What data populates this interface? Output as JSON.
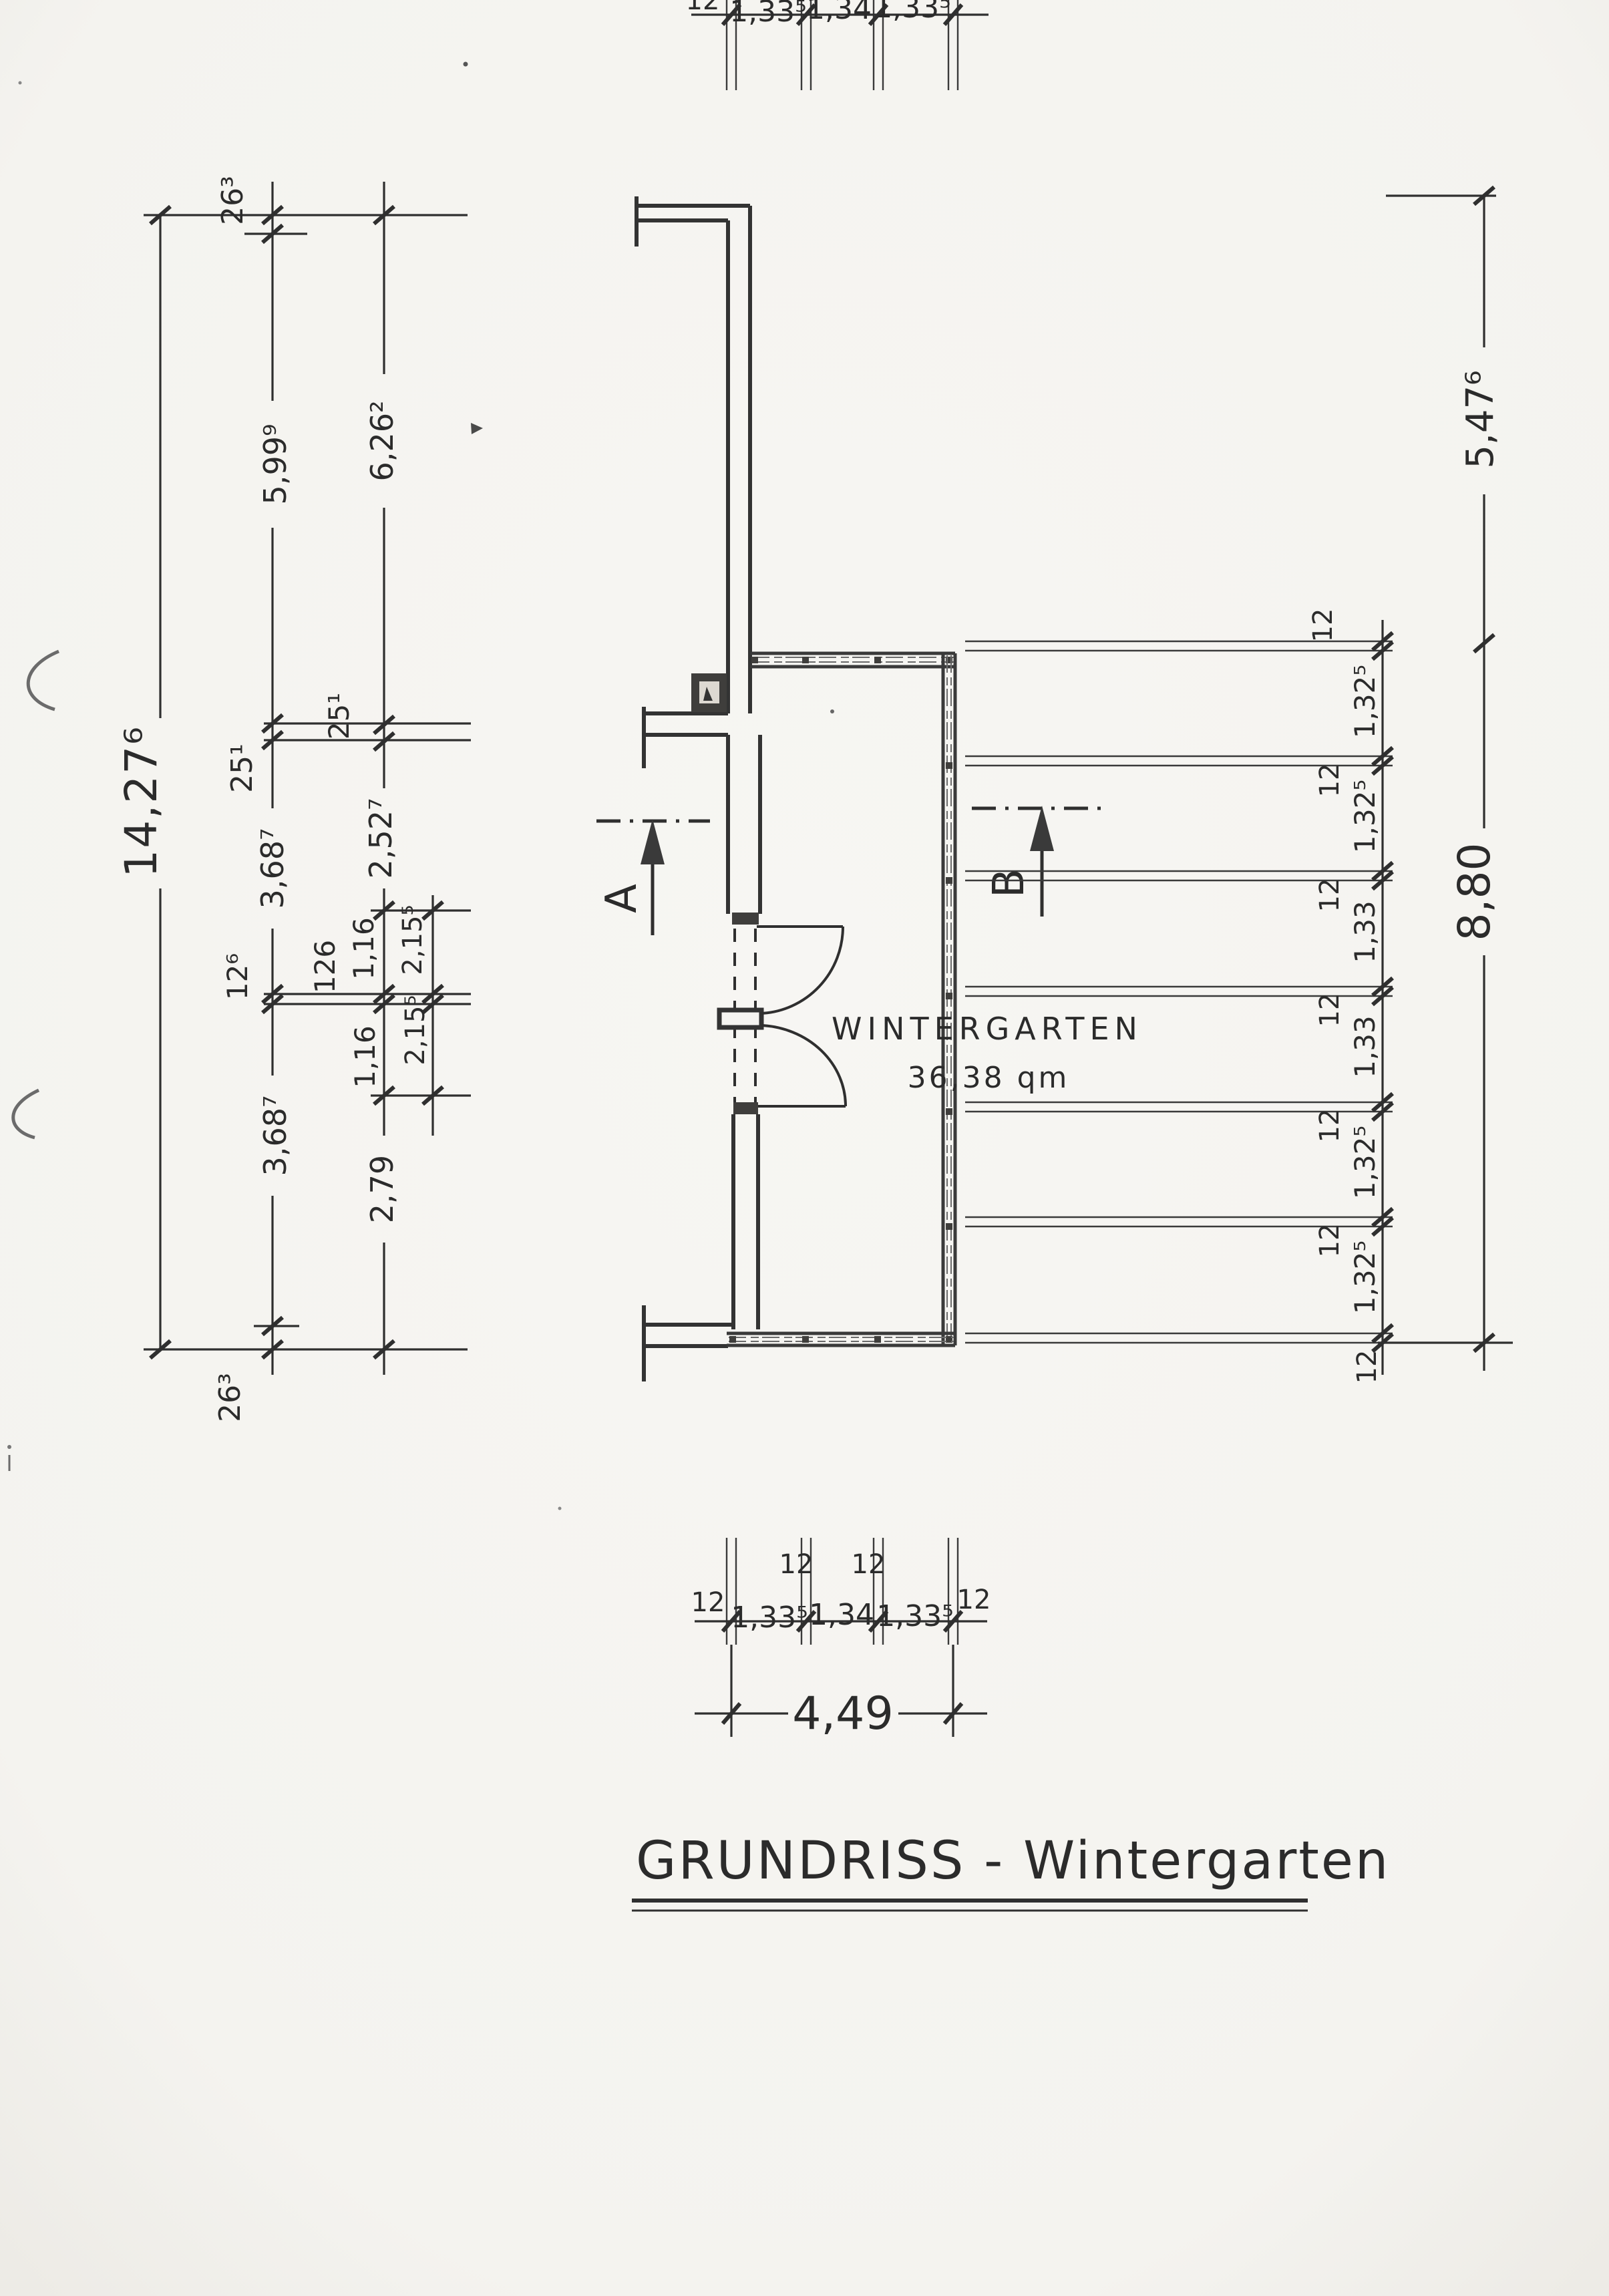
{
  "page": {
    "paper_color": "#f5f4f1",
    "ink_color": "#2b2b2b"
  },
  "title": {
    "text": "GRUNDRISS - Wintergarten"
  },
  "room": {
    "name": "WINTERGARTEN",
    "area": "36,38 qm"
  },
  "sections": {
    "a": "A",
    "b": "B"
  },
  "dims": {
    "left": {
      "total": "14,27⁶",
      "chain2": [
        "26³",
        "5,99⁹",
        "25¹",
        "3,68⁷",
        "12⁶",
        "3,68⁷",
        "26³"
      ],
      "chain3": [
        "6,26²",
        "25¹",
        "2,52⁷",
        "1,16",
        "126",
        "1,16",
        "2,79"
      ],
      "chain4": [
        "2,15⁵",
        "2,15⁵"
      ]
    },
    "right": {
      "mullions": [
        "12",
        "12",
        "12",
        "12",
        "12",
        "12",
        "12"
      ],
      "panels": [
        "1,32⁵",
        "1,32⁵",
        "1,33",
        "1,33",
        "1,32⁵",
        "1,32⁵"
      ],
      "glass_wall_total": "8,80",
      "side_total": "5,47⁶"
    },
    "bottom": {
      "mullions": [
        "12",
        "12",
        "12",
        "12"
      ],
      "panels": [
        "1,33⁵",
        "1,34",
        "1,33⁵"
      ],
      "total": "4,49"
    },
    "top": {
      "mullions": [
        "12"
      ],
      "panels": [
        "1,33⁵",
        "1,34",
        "1,33⁵"
      ]
    }
  }
}
